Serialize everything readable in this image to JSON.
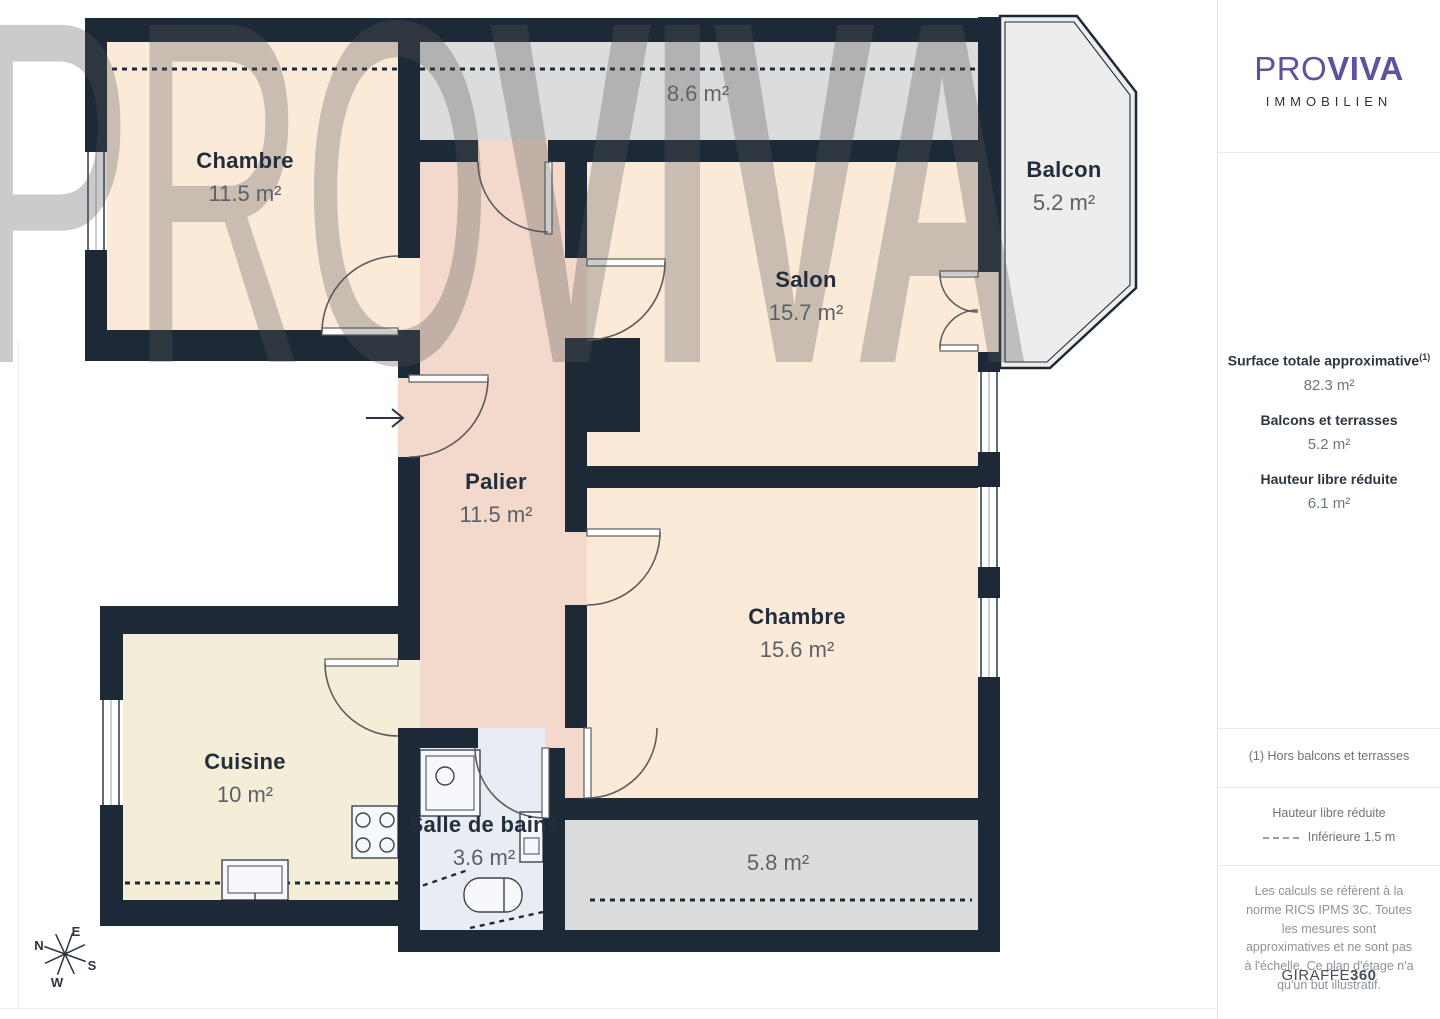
{
  "watermark": {
    "pro": "PRO",
    "viva": "VIVA"
  },
  "compass": {
    "n": "N",
    "e": "E",
    "s": "S",
    "w": "W"
  },
  "plan": {
    "rooms": [
      {
        "name": "Chambre",
        "area": "11.5 m²"
      },
      {
        "name": "Salon",
        "area": "15.7 m²"
      },
      {
        "name": "Chambre",
        "area": "15.6 m²"
      },
      {
        "name": "Cuisine",
        "area": "10 m²"
      },
      {
        "name": "Palier",
        "area": "11.5 m²"
      },
      {
        "name": "Salle de bains",
        "area": "3.6 m²"
      },
      {
        "name": "Balcon",
        "area": "5.2 m²"
      }
    ],
    "zones": [
      {
        "area": "8.6 m²"
      },
      {
        "area": "5.8 m²"
      }
    ]
  },
  "sidebar": {
    "logo": {
      "pro": "PRO",
      "viva": "VIVA",
      "subtitle": "IMMOBILIEN"
    },
    "metrics": [
      {
        "label": "Surface totale approximative",
        "sup": "(1)",
        "value": "82.3 m²"
      },
      {
        "label": "Balcons et terrasses",
        "sup": "",
        "value": "5.2 m²"
      },
      {
        "label": "Hauteur libre réduite",
        "sup": "",
        "value": "6.1 m²"
      }
    ],
    "footnote": "(1) Hors balcons et terrasses",
    "legend": {
      "title": "Hauteur libre réduite",
      "item": "Inférieure 1.5 m"
    },
    "disclaimer": "Les calculs se réfèrent à la norme RICS IPMS 3C. Toutes les mesures sont approximatives et ne sont pas à l'échelle. Ce plan d'étage n'a qu'un but illustratif.",
    "brand": {
      "name": "GIRAFFE",
      "suffix": "360"
    }
  }
}
